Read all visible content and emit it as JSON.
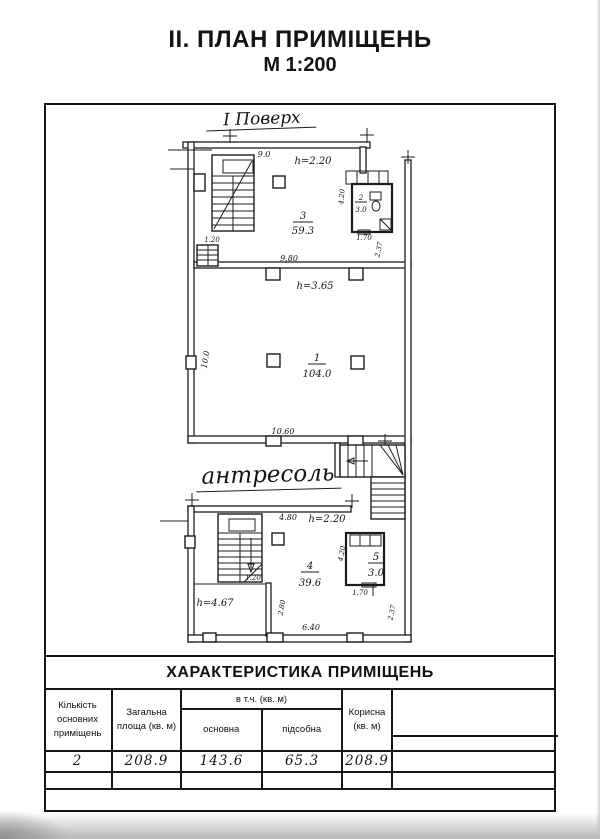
{
  "page": {
    "title_line1": "ІІ. ПЛАН ПРИМІЩЕНЬ",
    "title_line2": "М 1:200"
  },
  "floor1": {
    "caption": "І Поверх",
    "dim_top_width": "9.0",
    "room3_height": "h=2.20",
    "room2_num": "2",
    "room2_area": "3.0",
    "dim_wc_height": "4.20",
    "dim_wc_width": "1.70",
    "dim_right_height": "2.37",
    "room3_num": "3",
    "room3_area": "59.3",
    "dim_stair_width": "1.20",
    "dim_mid_width": "9.80",
    "room1_height": "h=3.65",
    "room1_num": "1",
    "room1_area": "104.0",
    "dim_left_height": "10.0",
    "dim_bottom_width": "10.60"
  },
  "mezzanine": {
    "caption": "антресоль",
    "dim_top_width": "4.80",
    "room4_height": "h=2.20",
    "dim_room5_height": "4.20",
    "room5_num": "5",
    "room5_area": "3.0",
    "dim_stair_door": "1.20",
    "room4_num": "4",
    "room4_area": "39.6",
    "left_zone_height": "h=4.67",
    "dim_inner_height": "2.80",
    "dim_bottom_width": "6.40",
    "dim_room5_width": "1.70",
    "dim_right_height": "2.37"
  },
  "table": {
    "title": "ХАРАКТЕРИСТИКА ПРИМІЩЕНЬ",
    "group_header": "в т.ч. (кв. м)",
    "col_count": "Кількість основних приміщень",
    "col_total": "Загальна площа (кв. м)",
    "col_main": "основна",
    "col_aux": "підсобна",
    "col_useful": "Корисна (кв. м)",
    "val_count": "2",
    "val_total": "208.9",
    "val_main": "143.6",
    "val_aux": "65.3",
    "val_useful": "208.9"
  }
}
